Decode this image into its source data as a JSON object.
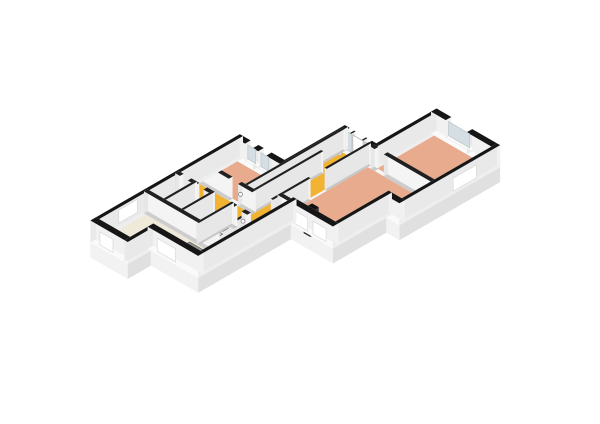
{
  "scene": {
    "title": "Isometric 3D floor plan of an apartment with three bedrooms, entrance hall, corridor, living room, bathroom, toilet and stairwell",
    "canvas": {
      "width": 600,
      "height": 424,
      "background": "#ffffff"
    },
    "projection": {
      "xScale": 0.82,
      "yScale": 1.45,
      "yOffset": -1.8,
      "cx": 1.6,
      "cy": 0.924,
      "originX": 368,
      "originY": 84,
      "wallHeight": 22,
      "slabDepth": 15
    },
    "colors": {
      "capExt": "#161616",
      "capInt": "#202020",
      "extN": "#f1f1f1",
      "extS": "#fafafa",
      "extW": "#e9e9e9",
      "extE": "#eeeeee",
      "intN": "#f4f4f4",
      "intS": "#cdcdcd",
      "intW": "#e7e7e7",
      "intE": "#c6c6c6",
      "darkFace": "#2e2e2e",
      "darkCap": "#101010",
      "glass": "#d5dee3",
      "glassEdge": "#b7c1c7",
      "sill": "#fbfbfb",
      "doorLeaf": "#fdfdfd",
      "doorLeafEdge": "#b0b0b0",
      "windowPanel": "#ffffff",
      "windowPanelEdge": "#d9d9d9",
      "slabTop": "#f7f7f7",
      "slabSideS": "#f2f2f2",
      "slabSideE": "#e0e0e0",
      "slabSideW": "#eaeaea",
      "hall": "#f2b232",
      "bedroom": "#e9ab8d",
      "living": "#eee9d8",
      "bath": "#c9d4db",
      "toiletRoom": "#e8e8e8",
      "storage": "#ececec",
      "deadzone": "#dcdcdc",
      "treadShades": [
        "#cfcfcf",
        "#c1c1c1",
        "#b2b2b2",
        "#a3a3a3",
        "#949494"
      ],
      "treadEdge": "#3a3a3a",
      "fixtureLight": "#f6f6f6",
      "fixtureMid": "#e3e3e3",
      "fixtureShade": "#d0d0d0",
      "handleFill": "#ffffff",
      "handleRing": "#858585",
      "pendant": "#d8d8d8",
      "pendantStem": "#9a9a9a"
    },
    "slab": {
      "outline": [
        [
          -1.2,
          55.8
        ],
        [
          35.2,
          55.8
        ],
        [
          35.2,
          29.8
        ],
        [
          59.2,
          29.8
        ],
        [
          59.2,
          3.8
        ],
        [
          105.2,
          3.8
        ],
        [
          105.2,
          47.2
        ],
        [
          95.2,
          47.2
        ],
        [
          95.2,
          70.2
        ],
        [
          63.2,
          70.2
        ],
        [
          63.2,
          110.2
        ],
        [
          27.2,
          110.2
        ],
        [
          27.2,
          120.2
        ],
        [
          -1.2,
          120.2
        ]
      ],
      "depth": 15
    },
    "floors": [
      {
        "room": "bedroom-1",
        "color": "#e9ab8d",
        "points": [
          [
            1.2,
            58.2
          ],
          [
            33.7,
            58.2
          ],
          [
            33.7,
            73.2
          ],
          [
            1.2,
            73.2
          ]
        ]
      },
      {
        "room": "bedroom-2",
        "color": "#e9ab8d",
        "points": [
          [
            59.2,
            6.2
          ],
          [
            102.8,
            6.2
          ],
          [
            102.8,
            30.7
          ],
          [
            59.2,
            30.7
          ]
        ]
      },
      {
        "room": "bedroom-3",
        "color": "#e9ab8d",
        "points": [
          [
            54.8,
            32.3
          ],
          [
            102.8,
            32.3
          ],
          [
            102.8,
            44.8
          ],
          [
            92.8,
            44.8
          ],
          [
            92.8,
            68.2
          ],
          [
            54.8,
            68.2
          ]
        ]
      },
      {
        "room": "entrance-hall",
        "color": "#f2b232",
        "points": [
          [
            35.3,
            32.2
          ],
          [
            53.2,
            32.2
          ],
          [
            53.2,
            44.2
          ],
          [
            35.3,
            44.2
          ]
        ]
      },
      {
        "room": "hall-stem",
        "color": "#f2b232",
        "points": [
          [
            41.8,
            44.2
          ],
          [
            53.2,
            44.2
          ],
          [
            53.2,
            82.7
          ],
          [
            41.8,
            82.7
          ]
        ]
      },
      {
        "room": "corridor",
        "color": "#f2b232",
        "points": [
          [
            1.2,
            74.8
          ],
          [
            54.8,
            74.8
          ],
          [
            54.8,
            82.7
          ],
          [
            1.2,
            82.7
          ]
        ]
      },
      {
        "room": "duct-zone",
        "color": "#dcdcdc",
        "points": [
          [
            35.3,
            45.8
          ],
          [
            40.2,
            45.8
          ],
          [
            40.2,
            74
          ],
          [
            35.3,
            74
          ]
        ]
      },
      {
        "room": "toilet-room",
        "color": "#e8e8e8",
        "points": [
          [
            1.2,
            84.3
          ],
          [
            12.2,
            84.3
          ],
          [
            12.2,
            96.2
          ],
          [
            1.2,
            96.2
          ]
        ]
      },
      {
        "room": "storage-room",
        "color": "#ececec",
        "points": [
          [
            13.8,
            84.3
          ],
          [
            25.7,
            84.3
          ],
          [
            25.7,
            96.2
          ],
          [
            13.8,
            96.2
          ]
        ]
      },
      {
        "room": "bathroom",
        "color": "#c9d4db",
        "points": [
          [
            41.8,
            84.3
          ],
          [
            53.2,
            84.3
          ],
          [
            53.2,
            96.2
          ],
          [
            41.8,
            96.2
          ]
        ]
      },
      {
        "room": "living-room",
        "color": "#eee9d8",
        "points": [
          [
            54.8,
            70.3
          ],
          [
            60.8,
            70.3
          ],
          [
            60.8,
            108.2
          ],
          [
            25.2,
            108.2
          ],
          [
            25.2,
            118.2
          ],
          [
            1.2,
            118.2
          ],
          [
            1.2,
            97.8
          ],
          [
            54.8,
            97.8
          ]
        ]
      }
    ],
    "walls": [
      {
        "id": "e1",
        "dir": "h",
        "at": 57,
        "from": -1.2,
        "to": 35.2,
        "t": 2.4,
        "type": "ext",
        "gaps": [
          {
            "from": 7,
            "to": 13,
            "kind": "window"
          },
          {
            "from": 17,
            "to": 23,
            "kind": "window"
          }
        ]
      },
      {
        "id": "e2",
        "dir": "v",
        "at": 34,
        "from": 29.8,
        "to": 58.2,
        "t": 2.4,
        "type": "ext",
        "gaps": []
      },
      {
        "id": "e3",
        "dir": "h",
        "at": 31,
        "from": 32.8,
        "to": 59.2,
        "t": 2.4,
        "type": "ext",
        "gaps": [
          {
            "from": 36.5,
            "to": 40,
            "kind": "sidelight"
          },
          {
            "from": 41,
            "to": 49,
            "kind": "doorleaf"
          },
          {
            "from": 50,
            "to": 53.5,
            "kind": "sidelight"
          }
        ]
      },
      {
        "id": "e4",
        "dir": "v",
        "at": 58,
        "from": 3.8,
        "to": 32.2,
        "t": 2.4,
        "type": "ext",
        "gaps": []
      },
      {
        "id": "e5",
        "dir": "h",
        "at": 5,
        "from": 56.8,
        "to": 105.2,
        "t": 2.4,
        "type": "ext",
        "gaps": [
          {
            "from": 68,
            "to": 84,
            "kind": "window"
          }
        ]
      },
      {
        "id": "e6",
        "dir": "v",
        "at": 104,
        "from": 3.8,
        "to": 47.2,
        "t": 2.4,
        "type": "ext",
        "gaps": [],
        "panels": [
          {
            "from": 14,
            "to": 24
          }
        ],
        "panelFace": "E"
      },
      {
        "id": "e7",
        "dir": "h",
        "at": 46,
        "from": 92.8,
        "to": 105.2,
        "t": 2.4,
        "type": "ext",
        "gaps": []
      },
      {
        "id": "e8",
        "dir": "v",
        "at": 94,
        "from": 44.8,
        "to": 70.2,
        "t": 2.4,
        "type": "ext",
        "gaps": []
      },
      {
        "id": "e9",
        "dir": "h",
        "at": 69,
        "from": 60.8,
        "to": 95.2,
        "t": 2.4,
        "type": "ext",
        "gaps": [],
        "panels": [
          {
            "from": 66,
            "to": 76
          },
          {
            "from": 80,
            "to": 90
          }
        ],
        "panelFace": "S"
      },
      {
        "id": "chimney",
        "dir": "h",
        "at": 69,
        "from": 74,
        "to": 79,
        "t": 3.6,
        "type": "ext",
        "gaps": [],
        "dark": true,
        "h": 25
      },
      {
        "id": "e10",
        "dir": "v",
        "at": 62,
        "from": 67.8,
        "to": 110.2,
        "t": 2.4,
        "type": "ext",
        "gaps": []
      },
      {
        "id": "e11",
        "dir": "h",
        "at": 109,
        "from": 24.8,
        "to": 63.2,
        "t": 2.4,
        "type": "ext",
        "gaps": [],
        "panels": [
          {
            "from": 32,
            "to": 46
          }
        ],
        "panelFace": "S"
      },
      {
        "id": "e12",
        "dir": "v",
        "at": 26,
        "from": 107.8,
        "to": 120.2,
        "t": 2.4,
        "type": "ext",
        "gaps": []
      },
      {
        "id": "e13",
        "dir": "h",
        "at": 119,
        "from": -1.2,
        "to": 27.2,
        "t": 2.4,
        "type": "ext",
        "gaps": [],
        "panels": [
          {
            "from": 6,
            "to": 16
          }
        ],
        "panelFace": "S"
      },
      {
        "id": "e14",
        "dir": "v",
        "at": 0,
        "from": 55.8,
        "to": 120.2,
        "t": 2.4,
        "type": "ext",
        "gaps": [],
        "panels": [
          {
            "from": 100,
            "to": 108
          }
        ],
        "panelFace": "W"
      },
      {
        "id": "i1",
        "dir": "h",
        "at": 74,
        "from": 0,
        "to": 41.8,
        "t": 1.6,
        "type": "int",
        "gaps": [
          {
            "from": 24,
            "to": 31,
            "kind": "door"
          }
        ]
      },
      {
        "id": "i2",
        "dir": "v",
        "at": 34.5,
        "from": 31,
        "to": 74.8,
        "t": 1.6,
        "type": "int",
        "gaps": []
      },
      {
        "id": "i3",
        "dir": "v",
        "at": 41,
        "from": 44.2,
        "to": 74.8,
        "t": 1.6,
        "type": "int",
        "gaps": []
      },
      {
        "id": "i3b",
        "dir": "v",
        "at": 41,
        "from": 82.7,
        "to": 97.8,
        "t": 1.6,
        "type": "int",
        "gaps": []
      },
      {
        "id": "i4",
        "dir": "h",
        "at": 45,
        "from": 33.7,
        "to": 41.8,
        "t": 1.6,
        "type": "int",
        "gaps": []
      },
      {
        "id": "i5",
        "dir": "v",
        "at": 54,
        "from": 31,
        "to": 97.8,
        "t": 1.6,
        "type": "int",
        "gaps": [
          {
            "from": 50,
            "to": 57,
            "kind": "door"
          },
          {
            "from": 73.2,
            "to": 83.5,
            "kind": "open"
          }
        ]
      },
      {
        "id": "i6",
        "dir": "h",
        "at": 31.5,
        "from": 57,
        "to": 105.2,
        "t": 1.6,
        "type": "int",
        "gaps": [
          {
            "from": 60,
            "to": 67,
            "kind": "door"
          }
        ]
      },
      {
        "id": "i7",
        "dir": "h",
        "at": 83.5,
        "from": 0,
        "to": 27.3,
        "t": 1.6,
        "type": "int",
        "gaps": [
          {
            "from": 3.5,
            "to": 9.5,
            "kind": "door"
          },
          {
            "from": 15.5,
            "to": 21.5,
            "kind": "door"
          }
        ]
      },
      {
        "id": "i8",
        "dir": "v",
        "at": 13,
        "from": 82.7,
        "to": 97.8,
        "t": 1.6,
        "type": "int",
        "gaps": []
      },
      {
        "id": "i9",
        "dir": "h",
        "at": 97,
        "from": 0,
        "to": 54.8,
        "t": 1.6,
        "type": "int",
        "gaps": []
      },
      {
        "id": "i10",
        "dir": "v",
        "at": 26.5,
        "from": 82.7,
        "to": 97.8,
        "t": 1.6,
        "type": "int",
        "gaps": []
      },
      {
        "id": "i12",
        "dir": "h",
        "at": 83.5,
        "from": 40.2,
        "to": 54.8,
        "t": 1.6,
        "type": "int",
        "gaps": [
          {
            "from": 44.5,
            "to": 50.5,
            "kind": "door"
          }
        ]
      },
      {
        "id": "i13",
        "dir": "h",
        "at": 69.5,
        "from": 53.2,
        "to": 61.2,
        "t": 1.6,
        "type": "int",
        "gaps": []
      }
    ],
    "stairs": {
      "x1": 27.3,
      "x2": 40.2,
      "yStart": 84.2,
      "treadDepth": 2.35,
      "count": 5,
      "drop": 2.7
    },
    "toilet": {
      "tank": {
        "x1": 3.8,
        "x2": 9.4,
        "y1": 85.4,
        "y2": 87.6,
        "h": 10
      },
      "bowl": {
        "cx": 6.6,
        "cy": 90.6,
        "halfW": 2.6,
        "depthY": 2.2,
        "h": 7
      }
    },
    "pendant": {
      "x": 44.5,
      "y": 38.5,
      "topZ": 22,
      "ballZ": 14.5,
      "r": 2.2
    },
    "handles": [
      {
        "room": "bedroom-1",
        "x": 31.5,
        "y": 74
      },
      {
        "room": "bedroom-2",
        "x": 67.5,
        "y": 31.5
      },
      {
        "room": "bedroom-3",
        "x": 54,
        "y": 57.5
      },
      {
        "room": "toilet",
        "x": 9.2,
        "y": 83.5
      },
      {
        "room": "storage",
        "x": 21.2,
        "y": 83.5
      },
      {
        "room": "bathroom",
        "x": 50.2,
        "y": 83.5
      },
      {
        "room": "front-door",
        "x": 48.5,
        "y": 31
      }
    ]
  }
}
